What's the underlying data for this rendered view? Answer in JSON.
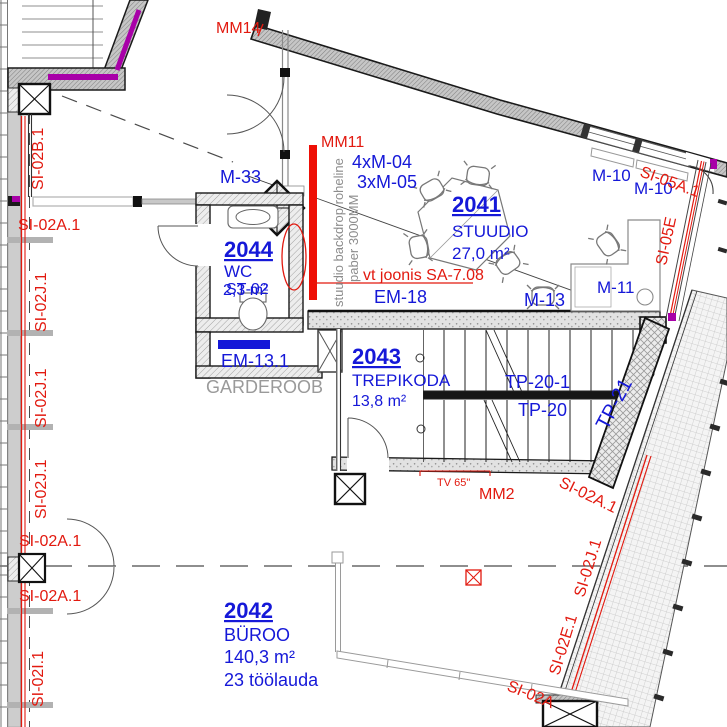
{
  "drawing_type": "architectural floor plan",
  "colors": {
    "blue": "#1518d8",
    "red": "#e2190f",
    "gray": "#8c8c8c",
    "lightgray": "#9a9a9a",
    "magenta": "#a800a8"
  },
  "labels": [
    {
      "name": "label-mm14",
      "text": "MM14",
      "x": 216,
      "y": 33,
      "color": "red",
      "size": 16
    },
    {
      "name": "label-mm11",
      "text": "MM11",
      "x": 321,
      "y": 147,
      "color": "red",
      "size": 16
    },
    {
      "name": "label-m33",
      "text": "M-33",
      "x": 220,
      "y": 183,
      "color": "blue",
      "size": 18
    },
    {
      "name": "label-4xm04",
      "text": "4xM-04",
      "x": 352,
      "y": 168,
      "color": "blue",
      "size": 18
    },
    {
      "name": "label-3xm05",
      "text": "3xM-05",
      "x": 357,
      "y": 188,
      "color": "blue",
      "size": 18
    },
    {
      "name": "room-2041-number",
      "text": "2041",
      "x": 452,
      "y": 212,
      "color": "blue",
      "size": 22,
      "bold": true,
      "underline": true
    },
    {
      "name": "room-2041-name",
      "text": "STUUDIO",
      "x": 452,
      "y": 237,
      "color": "blue",
      "size": 17
    },
    {
      "name": "room-2041-area",
      "text": "27,0 m²",
      "x": 452,
      "y": 259,
      "color": "blue",
      "size": 17
    },
    {
      "name": "label-m10-a",
      "text": "M-10",
      "x": 592,
      "y": 181,
      "color": "blue",
      "size": 17
    },
    {
      "name": "label-m10-b",
      "text": "M-10",
      "x": 634,
      "y": 194,
      "color": "blue",
      "size": 17
    },
    {
      "name": "label-si05a1",
      "text": "SI-05A.1",
      "x": 639,
      "y": 176,
      "color": "red",
      "size": 16,
      "rot": 20
    },
    {
      "name": "label-si05e",
      "text": "SI-05E",
      "x": 666,
      "y": 266,
      "color": "red",
      "size": 16,
      "rot": -78
    },
    {
      "name": "label-m11",
      "text": "M-11",
      "x": 597,
      "y": 293,
      "color": "blue",
      "size": 17
    },
    {
      "name": "label-m13",
      "text": "M-13",
      "x": 524,
      "y": 306,
      "color": "blue",
      "size": 18
    },
    {
      "name": "label-em18",
      "text": "EM-18",
      "x": 374,
      "y": 303,
      "color": "blue",
      "size": 18
    },
    {
      "name": "label-vt-joonis",
      "text": "vt joonis SA-7.08",
      "x": 363,
      "y": 280,
      "color": "red",
      "size": 16
    },
    {
      "name": "label-backdrop-line1",
      "text": "stuudio backdrop roheline",
      "x": 343,
      "y": 307,
      "color": "gray",
      "size": 13,
      "rot": -90
    },
    {
      "name": "label-backdrop-line2",
      "text": "paber 3000MM",
      "x": 358,
      "y": 282,
      "color": "gray",
      "size": 13,
      "rot": -90
    },
    {
      "name": "room-2044-number",
      "text": "2044",
      "x": 224,
      "y": 257,
      "color": "blue",
      "size": 22,
      "bold": true,
      "underline": true
    },
    {
      "name": "room-2044-name",
      "text": "WC",
      "x": 224,
      "y": 277,
      "color": "blue",
      "size": 17
    },
    {
      "name": "room-2044-area",
      "text": "2,3 m²",
      "x": 223,
      "y": 295,
      "color": "blue",
      "size": 16
    },
    {
      "name": "label-st02",
      "text": "ST-02",
      "x": 226,
      "y": 294,
      "color": "blue",
      "size": 16
    },
    {
      "name": "label-em13-1",
      "text": "EM-13.1",
      "x": 221,
      "y": 367,
      "color": "blue",
      "size": 18
    },
    {
      "name": "label-garderoob",
      "text": "GARDEROOB",
      "x": 206,
      "y": 393,
      "color": "lightgray",
      "size": 18
    },
    {
      "name": "room-2043-number",
      "text": "2043",
      "x": 352,
      "y": 364,
      "color": "blue",
      "size": 22,
      "bold": true,
      "underline": true
    },
    {
      "name": "room-2043-name",
      "text": "TREPIKODA",
      "x": 352,
      "y": 386,
      "color": "blue",
      "size": 17
    },
    {
      "name": "room-2043-area",
      "text": "13,8 m²",
      "x": 352,
      "y": 406,
      "color": "blue",
      "size": 16
    },
    {
      "name": "label-tp20-1",
      "text": "TP-20-1",
      "x": 505,
      "y": 388,
      "color": "blue",
      "size": 18
    },
    {
      "name": "label-tp20",
      "text": "TP-20",
      "x": 518,
      "y": 416,
      "color": "blue",
      "size": 18
    },
    {
      "name": "label-tp21",
      "text": "TP-21",
      "x": 607,
      "y": 431,
      "color": "blue",
      "size": 20,
      "rot": -62
    },
    {
      "name": "room-2042-number",
      "text": "2042",
      "x": 224,
      "y": 618,
      "color": "blue",
      "size": 22,
      "bold": true,
      "underline": true
    },
    {
      "name": "room-2042-name",
      "text": "BÜROO",
      "x": 224,
      "y": 641,
      "color": "blue",
      "size": 18
    },
    {
      "name": "room-2042-area",
      "text": "140,3 m²",
      "x": 224,
      "y": 663,
      "color": "blue",
      "size": 18
    },
    {
      "name": "room-2042-note",
      "text": "23 töölauda",
      "x": 224,
      "y": 686,
      "color": "blue",
      "size": 18
    },
    {
      "name": "label-mm2",
      "text": "MM2",
      "x": 479,
      "y": 499,
      "color": "red",
      "size": 16
    },
    {
      "name": "label-tv65",
      "text": "TV 65\"",
      "x": 437,
      "y": 486,
      "color": "red",
      "size": 11
    },
    {
      "name": "label-si02b1",
      "text": "SI-02B.1",
      "x": 43,
      "y": 190,
      "color": "red",
      "size": 16,
      "rot": -90
    },
    {
      "name": "label-si02a1-nw",
      "text": "SI-02A.1",
      "x": 18,
      "y": 230,
      "color": "red",
      "size": 16
    },
    {
      "name": "label-si02j1-w1",
      "text": "SI-02J.1",
      "x": 46,
      "y": 332,
      "color": "red",
      "size": 16,
      "rot": -90
    },
    {
      "name": "label-si02j1-w2",
      "text": "SI-02J.1",
      "x": 46,
      "y": 428,
      "color": "red",
      "size": 16,
      "rot": -90
    },
    {
      "name": "label-si02j1-w3",
      "text": "SI-02J.1",
      "x": 46,
      "y": 519,
      "color": "red",
      "size": 16,
      "rot": -90
    },
    {
      "name": "label-si02a1-w1",
      "text": "SI-02A.1",
      "x": 19,
      "y": 546,
      "color": "red",
      "size": 16
    },
    {
      "name": "label-si02a1-w2",
      "text": "SI-02A.1",
      "x": 19,
      "y": 601,
      "color": "red",
      "size": 16
    },
    {
      "name": "label-si02i1",
      "text": "SI-02I.1",
      "x": 43,
      "y": 707,
      "color": "red",
      "size": 16,
      "rot": -90
    },
    {
      "name": "label-si02a1-se",
      "text": "SI-02A.1",
      "x": 558,
      "y": 486,
      "color": "red",
      "size": 16,
      "rot": 26
    },
    {
      "name": "label-si02j1-e",
      "text": "SI-02J.1",
      "x": 584,
      "y": 598,
      "color": "red",
      "size": 16,
      "rot": -73
    },
    {
      "name": "label-si02e1",
      "text": "SI-02E.1",
      "x": 559,
      "y": 676,
      "color": "red",
      "size": 16,
      "rot": -73
    },
    {
      "name": "label-si02a-s",
      "text": "SI-02A",
      "x": 506,
      "y": 690,
      "color": "red",
      "size": 16,
      "rot": 22
    }
  ]
}
